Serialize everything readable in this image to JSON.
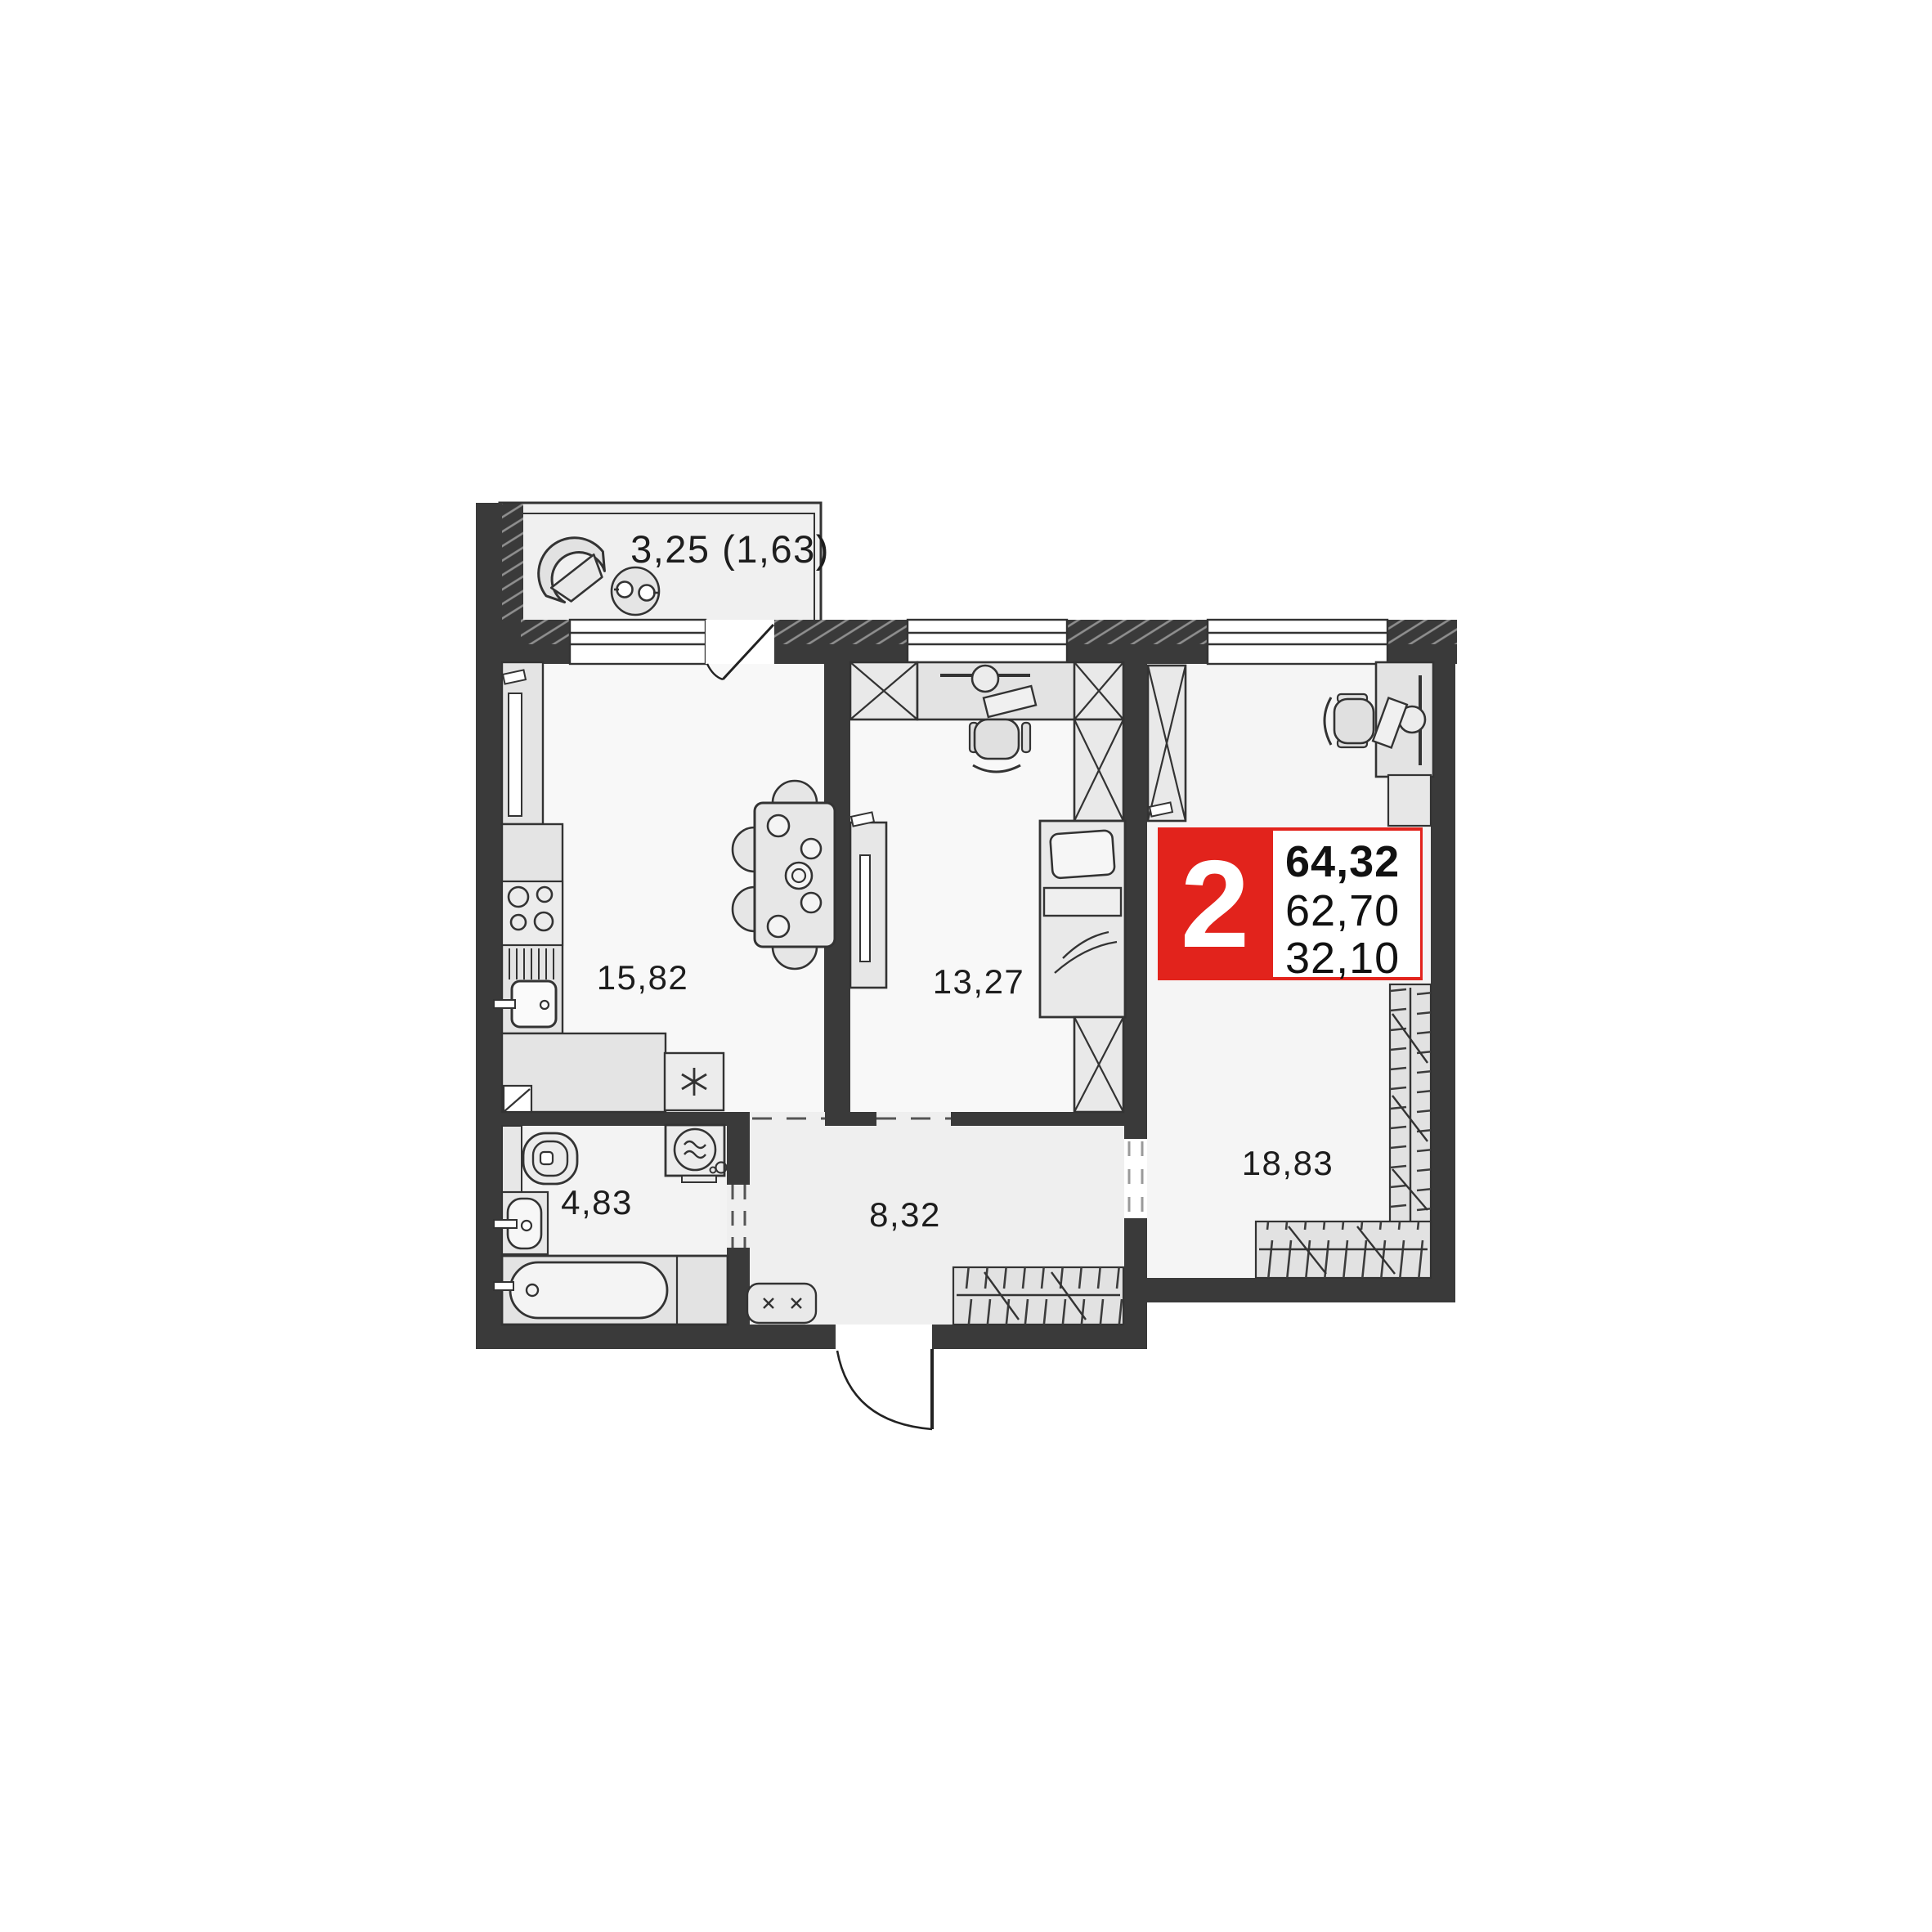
{
  "floorplan": {
    "title": "2-room apartment floor plan",
    "balcony": {
      "label": "3,25 (1,63)"
    },
    "rooms": [
      {
        "name": "kitchen-living",
        "area": "15,82"
      },
      {
        "name": "bedroom",
        "area": "13,27"
      },
      {
        "name": "living-room",
        "area": "18,83"
      },
      {
        "name": "bathroom",
        "area": "4,83"
      },
      {
        "name": "hallway",
        "area": "8,32"
      }
    ],
    "badge": {
      "rooms_count": "2",
      "area_total": "64,32",
      "area_without_balcony": "62,70",
      "area_living": "32,10"
    },
    "colors": {
      "accent_red": "#e2231c",
      "wall": "#3a3a3a"
    }
  }
}
